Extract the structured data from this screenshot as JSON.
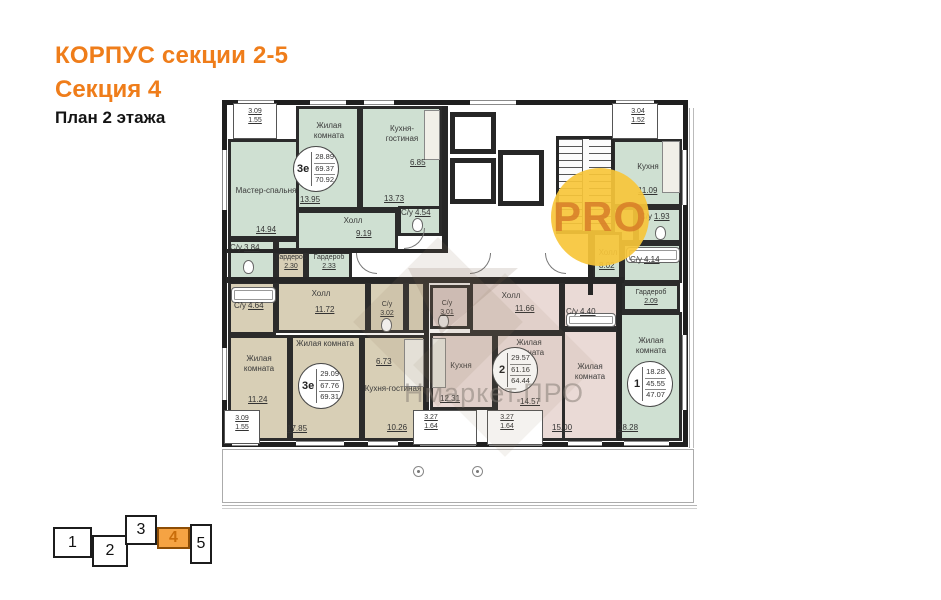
{
  "header": {
    "building": "КОРПУС секции 2-5",
    "section": "Секция 4",
    "floor": "План 2 этажа"
  },
  "watermarks": {
    "pro": "PRO",
    "brand": "Нмаркет.ПРО"
  },
  "colors": {
    "accent_orange": "#ef7d1a",
    "green_unit": "#cfe0d2",
    "beige_unit": "#d8cfb6",
    "pink_unit": "#eadad6",
    "wall": "#262626",
    "selector_highlight": "#f5a343",
    "watermark_yellow": "#f7c639"
  },
  "selector": {
    "items": [
      "1",
      "2",
      "3",
      "4",
      "5"
    ],
    "active": "4"
  },
  "plan": {
    "apt_a": {
      "badge": {
        "type": "3е",
        "v1": "28.89",
        "v2": "69.37",
        "v3": "70.92"
      },
      "balcony": {
        "v1": "3.09",
        "v2": "1.55"
      },
      "master": {
        "name": "Мастер-спальня",
        "area": "14.94"
      },
      "living": {
        "name": "Жилая комната",
        "area": "13.95"
      },
      "kitchen_living": {
        "name": "Кухня-гостиная",
        "area": "13.73",
        "area_upper": "6.85"
      },
      "hall": {
        "name": "Холл",
        "area": "9.19"
      },
      "bath1": {
        "name": "С/у",
        "area": "3.84"
      },
      "bath2": {
        "name": "С/у",
        "area": "4.54"
      },
      "wardrobe": {
        "name": "Гардероб",
        "area": "2.33"
      }
    },
    "apt_b": {
      "badge": {
        "type": "1",
        "v1": "18.28",
        "v2": "45.55",
        "v3": "47.07"
      },
      "balcony": {
        "v1": "3.04",
        "v2": "1.52"
      },
      "kitchen": {
        "name": "Кухня",
        "area": "11.09"
      },
      "bath1": {
        "name": "С/у",
        "area": "1.93"
      },
      "bath2": {
        "name": "С/у",
        "area": "4.14"
      },
      "hall": {
        "name": "Холл",
        "area": "8.02"
      },
      "wardrobe": {
        "name": "Гардероб",
        "area": "2.09"
      },
      "living": {
        "name": "Жилая комната",
        "area": "18.28"
      }
    },
    "apt_c": {
      "badge": {
        "type": "3е",
        "v1": "29.09",
        "v2": "67.76",
        "v3": "69.31"
      },
      "balcony": {
        "v1": "3.09",
        "v2": "1.55"
      },
      "bath1": {
        "name": "С/у",
        "area": "4.64"
      },
      "hall": {
        "name": "Холл",
        "area": "11.72"
      },
      "bath2": {
        "name": "С/у",
        "area": "3.02"
      },
      "living1": {
        "name": "Жилая комната",
        "area": "11.24"
      },
      "living2": {
        "name": "Жилая комната",
        "area": "17.85"
      },
      "kitchen_living": {
        "name": "Кухня-гостиная",
        "area": "10.26",
        "area_upper": "6.73"
      },
      "wardrobe": {
        "name": "Гардероб",
        "area": "2.30"
      }
    },
    "apt_d": {
      "badge": {
        "type": "2",
        "v1": "29.57",
        "v2": "61.16",
        "v3": "64.44"
      },
      "kitchen": {
        "name": "Кухня",
        "area": "12.31"
      },
      "bath1": {
        "name": "С/у",
        "area": "3.01"
      },
      "hall": {
        "name": "Холл",
        "area": "11.66"
      },
      "living1": {
        "name": "Жилая комната",
        "area": "14.57"
      },
      "living2": {
        "name": "Жилая комната",
        "area": "15.00"
      },
      "bath2": {
        "name": "С/у",
        "area": "4.40"
      },
      "loggia1": {
        "v1": "3.27",
        "v2": "1.64"
      },
      "loggia2": {
        "v1": "3.27",
        "v2": "1.64"
      }
    }
  }
}
